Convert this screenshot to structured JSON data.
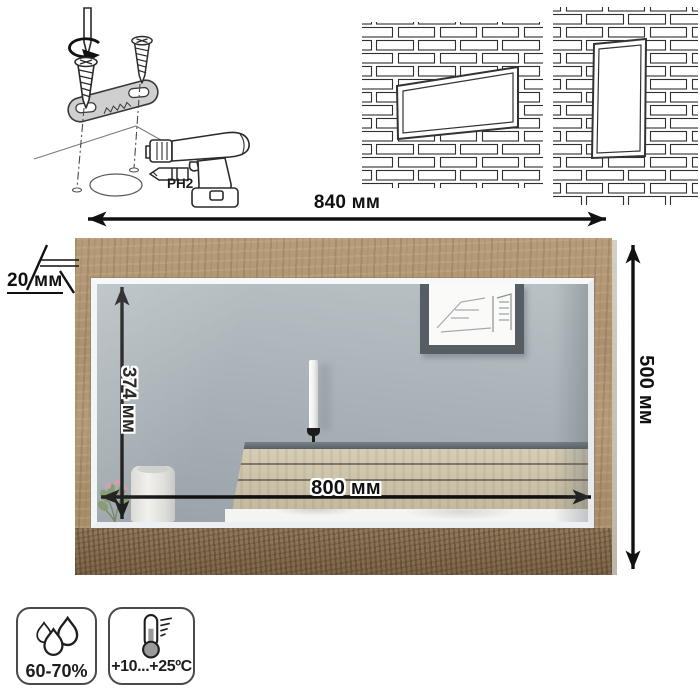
{
  "assembly": {
    "bit_label": "PH2",
    "icons": [
      "screwdriver-bit-icon",
      "rotation-arrow-icon",
      "screw-icon",
      "mounting-bracket-icon",
      "drill-icon",
      "ph2-bit-icon"
    ]
  },
  "mounting_previews": {
    "left_wall": "landscape mirror on brick wall",
    "right_wall": "portrait mirror on brick wall"
  },
  "dimensions": {
    "outer_width": "840 мм",
    "outer_height": "500 мм",
    "glass_height": "374 мм",
    "glass_width": "800 мм",
    "frame_thickness": "20 мм"
  },
  "specs": {
    "humidity": {
      "icon": "water-drops-icon",
      "label": "60-70%"
    },
    "temperature": {
      "icon": "thermometer-icon",
      "label": "+10...+25ºC"
    }
  },
  "colors": {
    "dimension_line": "#111111",
    "badge_border": "#4a4a4a",
    "frame_wood": "#ad9273",
    "frame_wood_dark": "#7f694e",
    "glass": "#a7b0b6",
    "headboard_wood": "#cdc3aa"
  }
}
